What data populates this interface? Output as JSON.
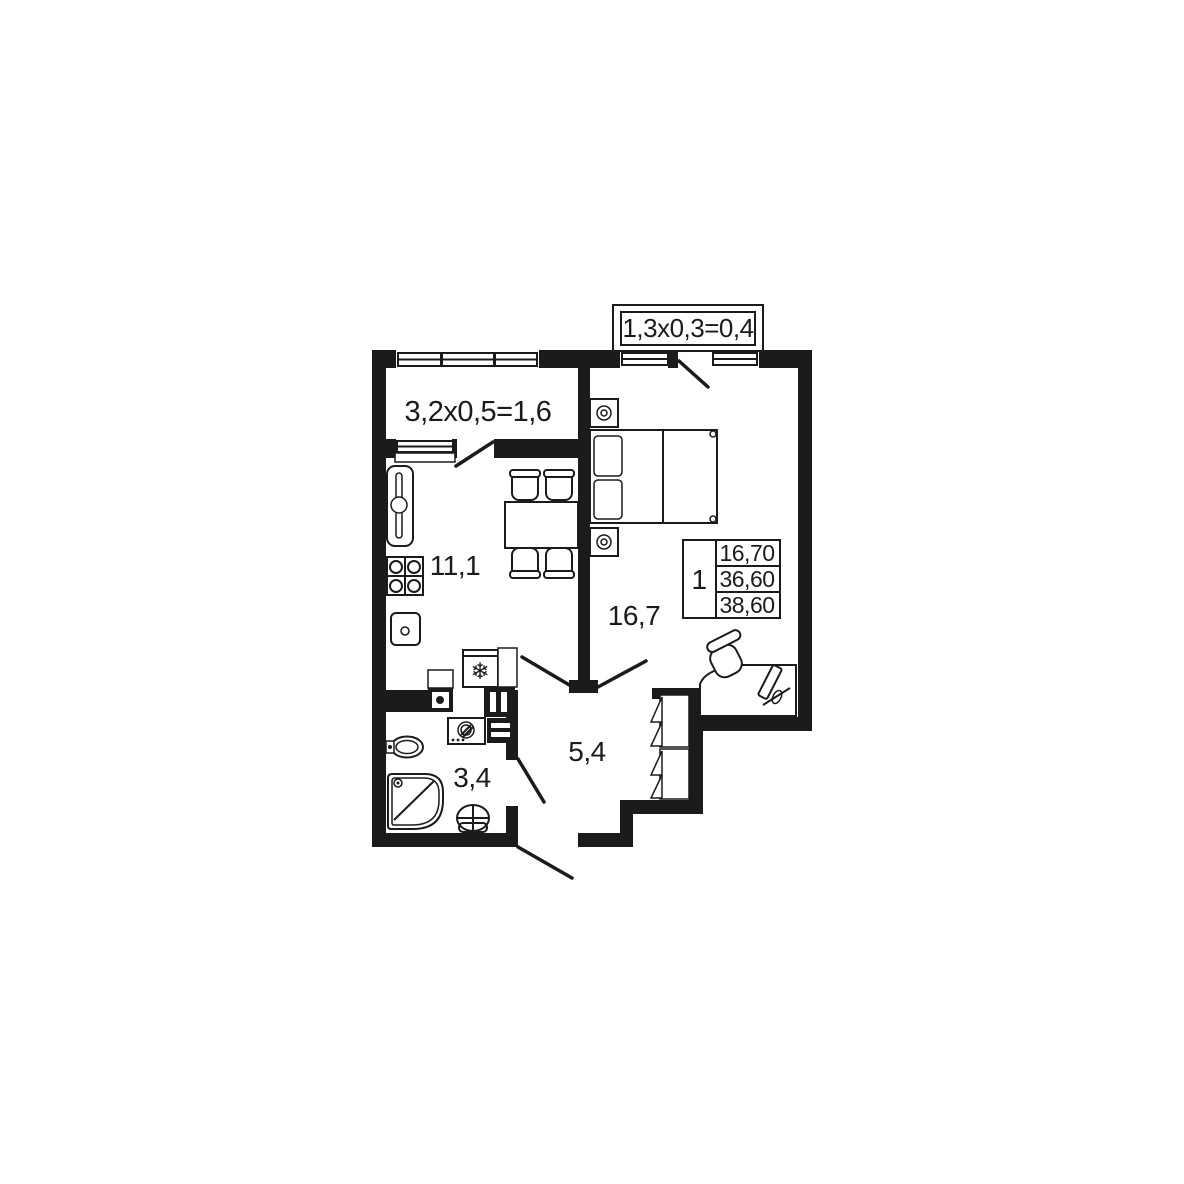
{
  "floor_plan": {
    "balcony_top": {
      "dimension_label": "1,3x0,3=0,4"
    },
    "balcony_side": {
      "dimension_label": "3,2x0,5=1,6"
    },
    "rooms": {
      "kitchen": {
        "area": "11,1"
      },
      "bedroom": {
        "area": "16,7"
      },
      "hallway": {
        "area": "5,4"
      },
      "bathroom": {
        "area": "3,4"
      }
    },
    "info_table": {
      "room_count": "1",
      "living_area": "16,70",
      "area_without_balcony": "36,60",
      "total_area": "38,60"
    },
    "icons": {
      "fridge_symbol": "❄"
    },
    "colors": {
      "walls": "#1b1b1b",
      "background": "#ffffff"
    }
  }
}
